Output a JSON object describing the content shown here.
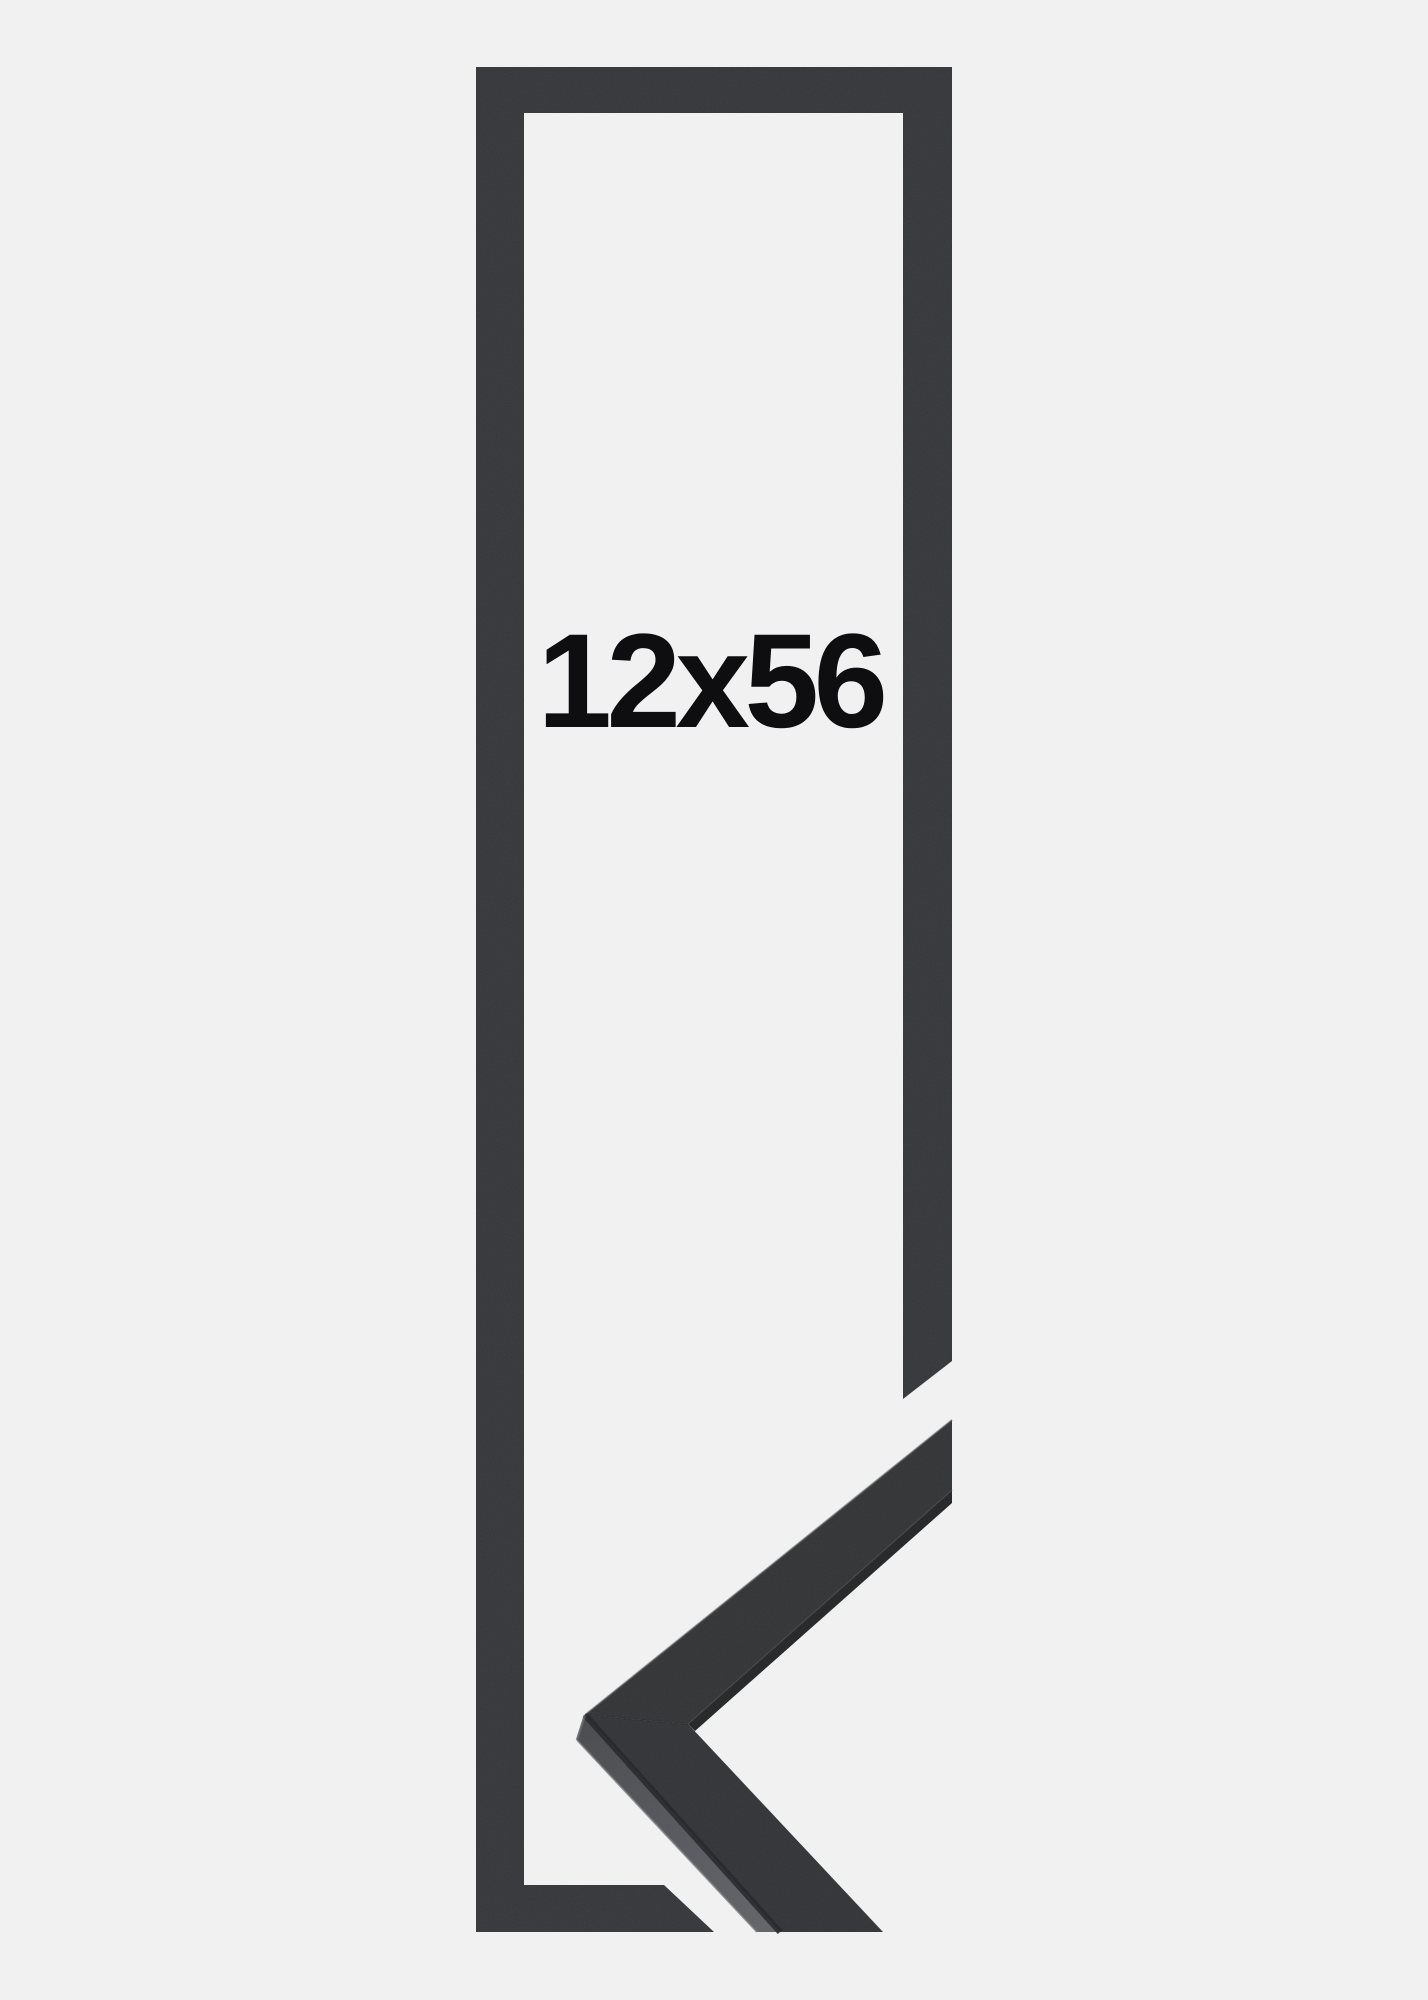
{
  "page": {
    "background_color": "#f1f1f2"
  },
  "graphic": {
    "size_label": "12x56",
    "label_color": "#0e0e10",
    "frame_outline_color": "#2f3033",
    "corner_sample": {
      "upper_arm_front_color": "#2c2d2f",
      "upper_arm_edge_color": "#1d1e20",
      "lower_arm_front_color": "#2c2d30",
      "side_face_color_top": "#434448",
      "side_face_color_bottom": "#5d5e63",
      "seam_dark_color": "#1b1c1e",
      "edge_highlight_color": "#727378"
    }
  }
}
